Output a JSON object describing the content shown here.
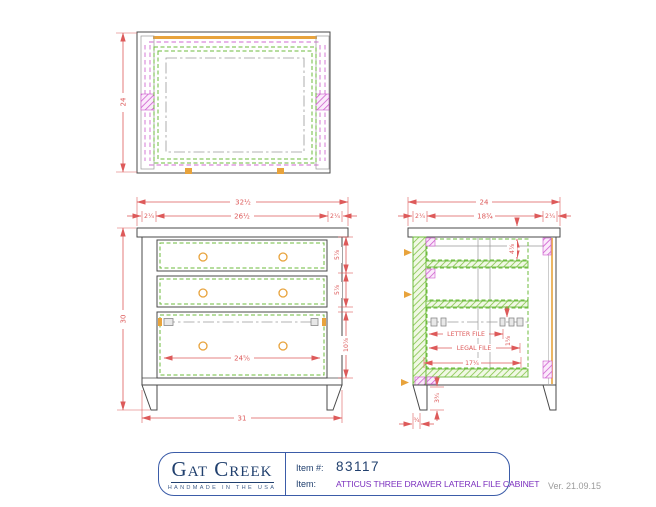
{
  "title_block": {
    "brand": "Gat Creek",
    "tagline": "HANDMADE IN THE USA",
    "item_number_label": "Item #:",
    "item_number": "83117",
    "item_label": "Item:",
    "item_name": "ATTICUS THREE DRAWER LATERAL FILE CABINET",
    "version": "Ver. 21.09.15"
  },
  "views": {
    "top": {
      "depth": "24"
    },
    "front": {
      "top_width": "32½",
      "left_stile": "2¼",
      "opening_width": "26½",
      "right_stile": "2¼",
      "height": "30",
      "drawer1": "5⅞",
      "drawer2": "5⅞",
      "drawer3": "10⅞",
      "drawer_opening": "24⅝",
      "base_width": "31"
    },
    "side": {
      "top_depth": "24",
      "front_stile": "2¼",
      "panel_depth": "18¾",
      "back_stile": "2¼",
      "top_opening": "4⅞",
      "letter_file": "LETTER FILE",
      "legal_file": "LEGAL FILE",
      "rail_offset": "1⅝",
      "interior_depth": "17¼",
      "leg_height": "3¾",
      "foot_taper": "¾"
    }
  },
  "colors": {
    "dimension_red": "#dd5a5a",
    "outline_gray": "#4a4a4a",
    "wood_green": "#6cbb3c",
    "panel_magenta": "#cc55cc",
    "hardware_orange": "#e8a33c",
    "centerline_gray": "#999999",
    "brand_navy": "#21406e",
    "item_purple": "#7b2fbe",
    "border_blue": "#3b5ca8"
  }
}
